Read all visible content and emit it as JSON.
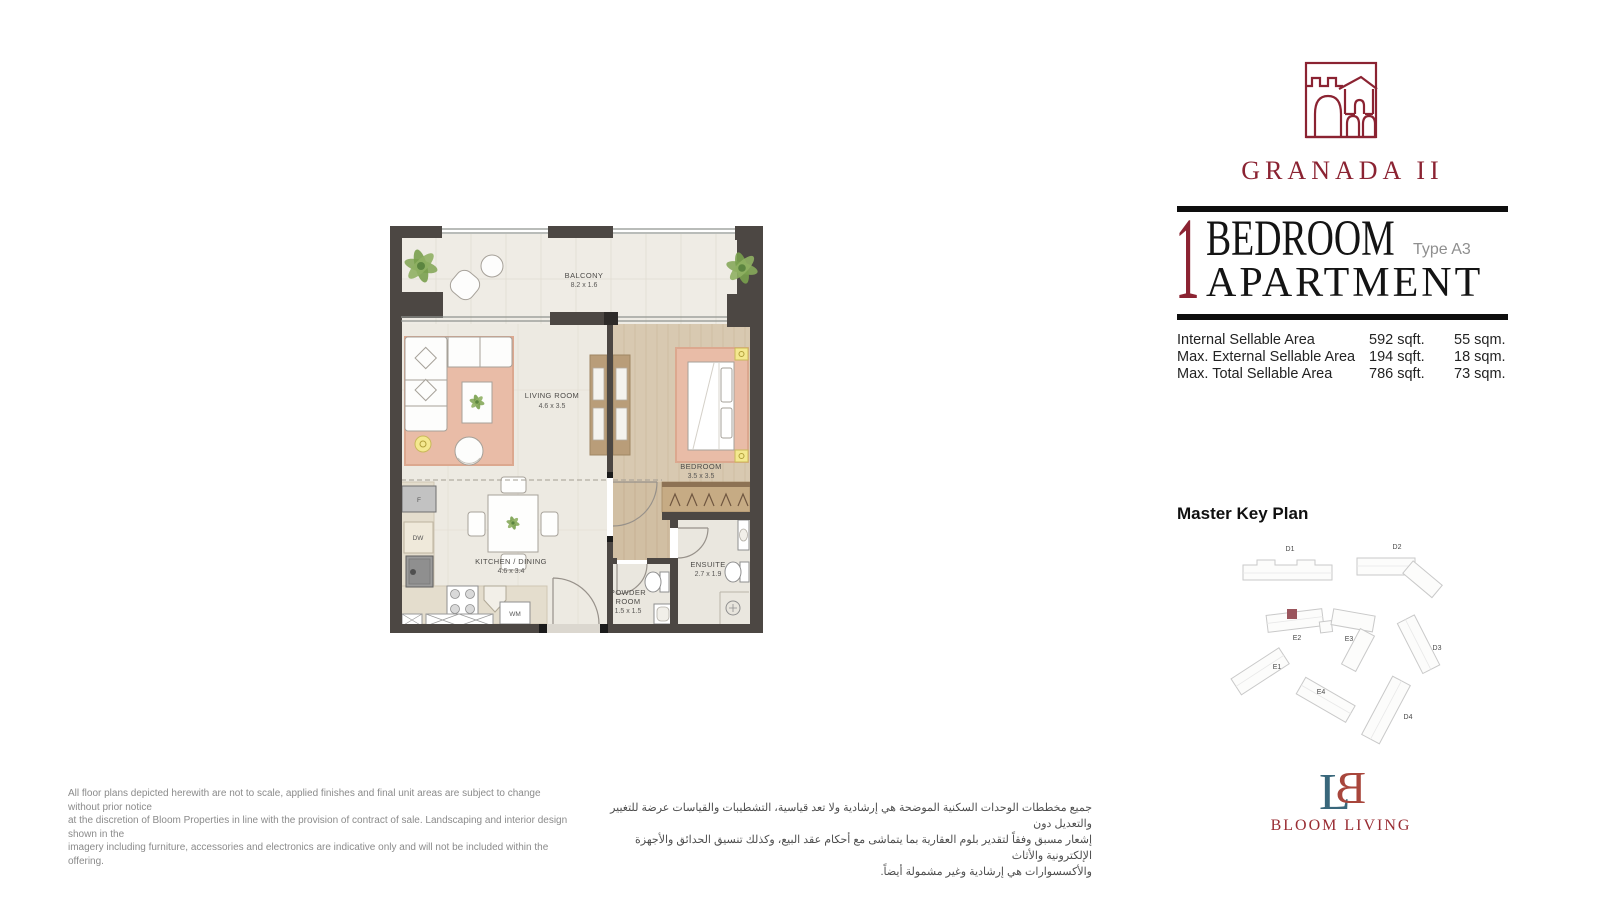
{
  "colors": {
    "brand_maroon": "#8B2332",
    "title_black": "#141414",
    "type_gray": "#8F8F8F",
    "bloom_teal": "#39677B",
    "bloom_red": "#A8463C",
    "keyplan_marker": "#9A545C",
    "wall": "#4C4743"
  },
  "brand": {
    "project_name": "GRANADA II",
    "developer": "BLOOM LIVING"
  },
  "unit": {
    "number": "1",
    "line1": "BEDROOM",
    "line2": "APARTMENT",
    "type": "Type A3"
  },
  "areas": {
    "rows": [
      {
        "label": "Internal Sellable Area",
        "sqft": "592 sqft.",
        "sqm": "55 sqm."
      },
      {
        "label": "Max. External Sellable Area",
        "sqft": "194 sqft.",
        "sqm": "18 sqm."
      },
      {
        "label": "Max. Total Sellable Area",
        "sqft": "786 sqft.",
        "sqm": "73 sqm."
      }
    ]
  },
  "master_key_plan": {
    "title": "Master Key Plan",
    "labels": [
      "D1",
      "D2",
      "E2",
      "E3",
      "D3",
      "E1",
      "E4",
      "D4"
    ]
  },
  "floorplan": {
    "rooms": [
      {
        "name": "BALCONY",
        "dim": "8.2 x 1.6"
      },
      {
        "name": "LIVING ROOM",
        "dim": "4.6 x 3.5"
      },
      {
        "name": "BEDROOM",
        "dim": "3.5 x 3.5"
      },
      {
        "name": "KITCHEN / DINING",
        "dim": "4.6 x 3.4"
      },
      {
        "name": "ENSUITE",
        "dim": "2.7 x 1.9"
      },
      {
        "name1": "POWDER",
        "name2": "ROOM",
        "dim": "1.5 x 1.5"
      }
    ],
    "appliances": {
      "fridge": "F",
      "dishwasher": "DW",
      "washer": "WM"
    }
  },
  "disclaimer_en": {
    "lines": [
      "All floor plans depicted herewith are not to scale, applied finishes and final unit areas are subject to change without prior notice",
      "at the discretion of Bloom Properties in line with the provision of contract of sale. Landscaping and interior design shown in the",
      "imagery including furniture, accessories and electronics are indicative only and will not be included within the offering."
    ]
  },
  "disclaimer_ar": {
    "lines": [
      "جميع مخططات الوحدات السكنية الموضحة هي إرشادية ولا تعد قياسية، التشطيبات والقياسات عرضة للتغيير والتعديل دون",
      "إشعار مسبق وفقاً لتقدير بلوم العقارية بما يتماشى مع أحكام عقد البيع، وكذلك تنسيق الحدائق والأجهزة الإلكترونية والأثاث",
      "والأكسسوارات هي إرشادية وغير مشمولة أيضاً."
    ]
  }
}
